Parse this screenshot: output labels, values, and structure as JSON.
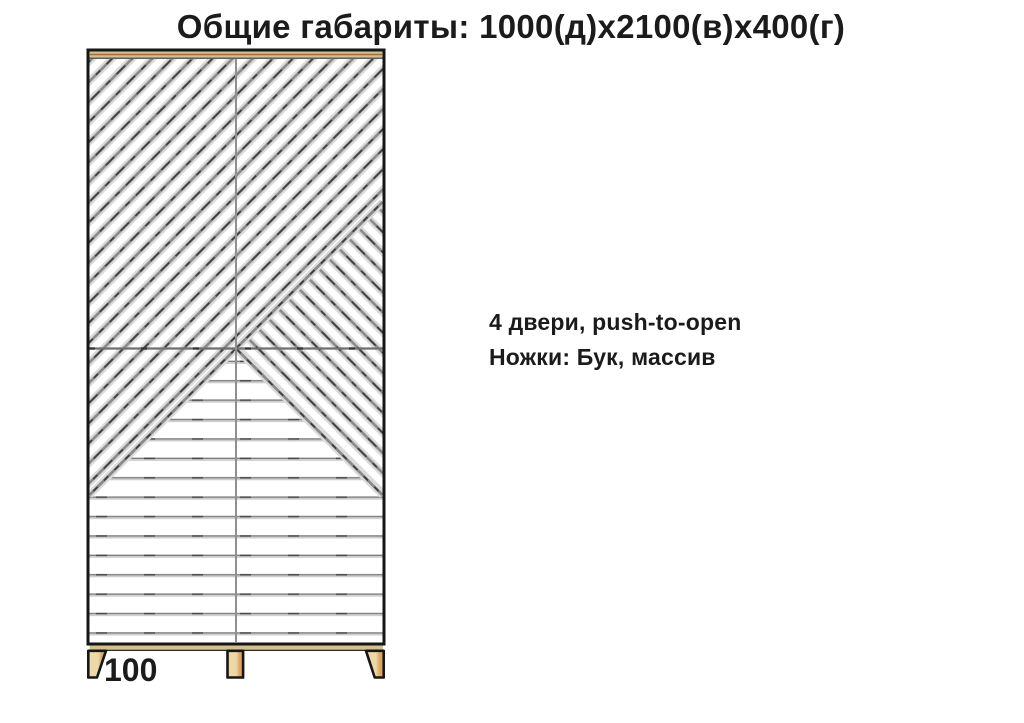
{
  "title": {
    "text": "Общие габариты: 1000(д)х2100(в)х400(г)"
  },
  "specs": {
    "doors": "4 двери, push-to-open",
    "legs": "Ножки: Бук, массив"
  },
  "dimensions": {
    "legs_height_mm": "100"
  },
  "colors": {
    "wood_light": "#eed8a9",
    "wood_dark": "#d9a665",
    "panel_edge": "#d3c08e",
    "edge_grain": "#a4693c",
    "outline": "#161616",
    "slat_gray": "#8a8a8a",
    "text": "#1b1b1b"
  }
}
